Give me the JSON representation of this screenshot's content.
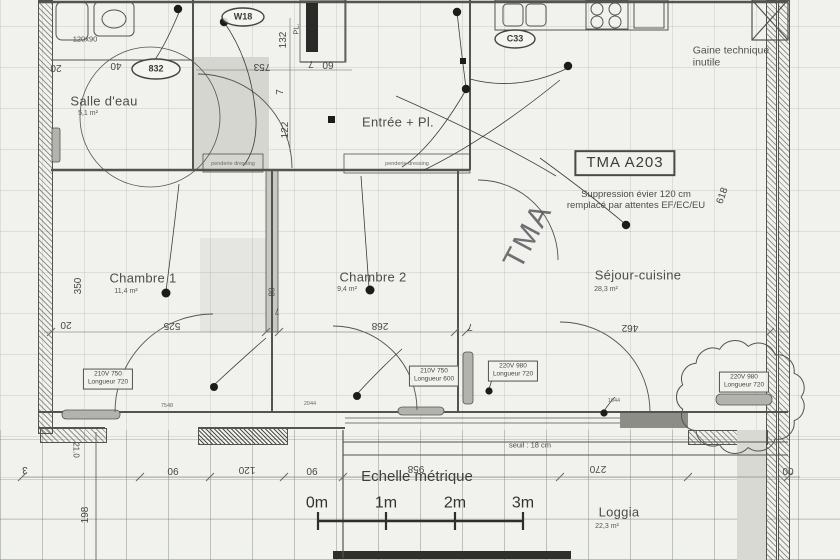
{
  "plan": {
    "unit_reference": "TMA A203",
    "rooms": [
      {
        "name": "Salle d'eau",
        "area": "5,1 m²"
      },
      {
        "name": "Entrée + Pl.",
        "area": ""
      },
      {
        "name": "Chambre 1",
        "area": "11,4 m²"
      },
      {
        "name": "Chambre 2",
        "area": "9,4 m²"
      },
      {
        "name": "Séjour-cuisine",
        "area": "28,3 m²"
      },
      {
        "name": "Loggia",
        "area": "22,3 m²"
      }
    ],
    "notes": [
      "Suppression évier 120 cm\nremplacé par attentes EF/EC/EU",
      "Gaine technique\ninutile",
      "seuil : 18 cm"
    ],
    "scale": {
      "title": "Echelle métrique",
      "ticks": [
        "0m",
        "1m",
        "2m",
        "3m"
      ]
    }
  },
  "labels": [
    {
      "id": "room-salle-deau",
      "text": "Salle d'eau",
      "x": 104,
      "y": 101,
      "cls": "room"
    },
    {
      "id": "area-salle-deau",
      "text": "5,1 m²",
      "x": 88,
      "y": 114,
      "cls": "area"
    },
    {
      "id": "room-entree",
      "text": "Entrée + Pl.",
      "x": 398,
      "y": 122,
      "cls": "room"
    },
    {
      "id": "room-chambre-1",
      "text": "Chambre 1",
      "x": 143,
      "y": 278,
      "cls": "room"
    },
    {
      "id": "area-chambre-1",
      "text": "11,4 m²",
      "x": 126,
      "y": 292,
      "cls": "area"
    },
    {
      "id": "room-chambre-2",
      "text": "Chambre 2",
      "x": 373,
      "y": 277,
      "cls": "room"
    },
    {
      "id": "area-chambre-2",
      "text": "9,4 m²",
      "x": 347,
      "y": 290,
      "cls": "area"
    },
    {
      "id": "room-sejour",
      "text": "Séjour-cuisine",
      "x": 638,
      "y": 275,
      "cls": "room"
    },
    {
      "id": "area-sejour",
      "text": "28,3 m²",
      "x": 606,
      "y": 290,
      "cls": "area"
    },
    {
      "id": "room-loggia",
      "text": "Loggia",
      "x": 619,
      "y": 512,
      "cls": "room"
    },
    {
      "id": "area-loggia",
      "text": "22,3 m²",
      "x": 607,
      "y": 527,
      "cls": "area"
    },
    {
      "id": "unit-ref",
      "text": "TMA A203",
      "x": 625,
      "y": 163,
      "cls": "refbox"
    },
    {
      "id": "note-suppression",
      "text": "Suppression évier 120 cm\nremplacé par attentes EF/EC/EU",
      "x": 636,
      "y": 200,
      "cls": "note"
    },
    {
      "id": "note-gaine",
      "text": "Gaine technique\ninutile",
      "x": 731,
      "y": 57,
      "cls": "note-left"
    },
    {
      "id": "watermark-tma",
      "text": "TMA",
      "x": 528,
      "y": 236,
      "rot": -62,
      "cls": "watermark"
    },
    {
      "id": "scale-title",
      "text": "Echelle métrique",
      "x": 417,
      "y": 477,
      "cls": "scale-title"
    },
    {
      "id": "scale-0m",
      "text": "0m",
      "x": 317,
      "y": 504,
      "cls": "scale-tick"
    },
    {
      "id": "scale-1m",
      "text": "1m",
      "x": 386,
      "y": 504,
      "cls": "scale-tick"
    },
    {
      "id": "scale-2m",
      "text": "2m",
      "x": 455,
      "y": 504,
      "cls": "scale-tick"
    },
    {
      "id": "scale-3m",
      "text": "3m",
      "x": 523,
      "y": 504,
      "cls": "scale-tick"
    },
    {
      "id": "dim-753",
      "text": "753",
      "x": 262,
      "y": 66,
      "rot": 180,
      "cls": "dim"
    },
    {
      "id": "dim-60",
      "text": "60",
      "x": 328,
      "y": 64,
      "rot": 180,
      "cls": "dim"
    },
    {
      "id": "dim-7-a",
      "text": "7",
      "x": 311,
      "y": 63,
      "rot": 180,
      "cls": "dim"
    },
    {
      "id": "dim-132",
      "text": "132",
      "x": 284,
      "y": 40,
      "rot": -90,
      "cls": "dim"
    },
    {
      "id": "dim-7-b",
      "text": "7",
      "x": 281,
      "y": 92,
      "rot": -90,
      "cls": "dim"
    },
    {
      "id": "dim-122",
      "text": "122",
      "x": 286,
      "y": 130,
      "rot": -90,
      "cls": "dim"
    },
    {
      "id": "dim-20-a",
      "text": "20",
      "x": 56,
      "y": 67,
      "rot": 180,
      "cls": "dim"
    },
    {
      "id": "dim-40",
      "text": "40",
      "x": 116,
      "y": 65,
      "rot": 180,
      "cls": "dim"
    },
    {
      "id": "dim-350",
      "text": "350",
      "x": 79,
      "y": 286,
      "rot": -90,
      "cls": "dim"
    },
    {
      "id": "dim-20-b",
      "text": "20",
      "x": 66,
      "y": 324,
      "rot": 180,
      "cls": "dim"
    },
    {
      "id": "dim-525",
      "text": "525",
      "x": 172,
      "y": 325,
      "rot": 180,
      "cls": "dim"
    },
    {
      "id": "dim-80",
      "text": "80",
      "x": 272,
      "y": 292,
      "rot": -90,
      "cls": "dim-sm"
    },
    {
      "id": "dim-7-c",
      "text": "7",
      "x": 277,
      "y": 311,
      "rot": 180,
      "cls": "dim-sm"
    },
    {
      "id": "dim-268",
      "text": "268",
      "x": 380,
      "y": 325,
      "rot": 180,
      "cls": "dim"
    },
    {
      "id": "dim-7-d",
      "text": "7",
      "x": 470,
      "y": 326,
      "rot": 180,
      "cls": "dim"
    },
    {
      "id": "dim-462",
      "text": "462",
      "x": 630,
      "y": 327,
      "rot": 180,
      "cls": "dim"
    },
    {
      "id": "dim-618",
      "text": "618",
      "x": 723,
      "y": 196,
      "rot": -70,
      "cls": "dim"
    },
    {
      "id": "dim-90-a",
      "text": "90",
      "x": 173,
      "y": 470,
      "rot": 180,
      "cls": "dim"
    },
    {
      "id": "dim-120",
      "text": "120",
      "x": 247,
      "y": 469,
      "rot": 180,
      "cls": "dim"
    },
    {
      "id": "dim-90-b",
      "text": "90",
      "x": 312,
      "y": 470,
      "rot": 180,
      "cls": "dim"
    },
    {
      "id": "dim-958",
      "text": "958",
      "x": 416,
      "y": 468,
      "rot": 180,
      "cls": "dim"
    },
    {
      "id": "dim-270",
      "text": "270",
      "x": 598,
      "y": 468,
      "rot": 180,
      "cls": "dim"
    },
    {
      "id": "dim-00",
      "text": "00",
      "x": 788,
      "y": 470,
      "rot": 180,
      "cls": "dim"
    },
    {
      "id": "dim-3",
      "text": "3",
      "x": 25,
      "y": 469,
      "rot": 180,
      "cls": "dim"
    },
    {
      "id": "dim-21-0",
      "text": "21.0",
      "x": 76,
      "y": 450,
      "rot": 90,
      "cls": "dim-sm"
    },
    {
      "id": "dim-198",
      "text": "198",
      "x": 86,
      "y": 515,
      "rot": -90,
      "cls": "dim"
    },
    {
      "id": "note-seuil",
      "text": "seuil : 18 cm",
      "x": 530,
      "y": 446,
      "cls": "tiny"
    },
    {
      "id": "tag-832",
      "text": "832",
      "x": 156,
      "y": 69,
      "cls": "oval-text"
    },
    {
      "id": "tag-w18",
      "text": "W18",
      "x": 243,
      "y": 17,
      "cls": "oval-text"
    },
    {
      "id": "tag-c33",
      "text": "C33",
      "x": 515,
      "y": 39,
      "cls": "oval-text"
    },
    {
      "id": "dim-120x90",
      "text": "120x90",
      "x": 85,
      "y": 40,
      "cls": "tiny"
    },
    {
      "id": "dim-pl",
      "text": "PL.",
      "x": 297,
      "y": 29,
      "rot": -90,
      "cls": "tiny"
    },
    {
      "id": "spec-chambre1",
      "text": "210V 750\nLongueur 720",
      "x": 108,
      "y": 379,
      "cls": "specbox"
    },
    {
      "id": "spec-chambre2",
      "text": "210V 750\nLongueur 600",
      "x": 434,
      "y": 376,
      "cls": "specbox"
    },
    {
      "id": "spec-sejour",
      "text": "220V 980\nLongueur 720",
      "x": 513,
      "y": 371,
      "cls": "specbox"
    },
    {
      "id": "spec-cloud",
      "text": "220V 980\nLongueur 720",
      "x": 744,
      "y": 382,
      "cls": "specbox"
    },
    {
      "id": "closet-label-1",
      "text": "penderie dressing",
      "x": 233,
      "y": 164,
      "cls": "micro"
    },
    {
      "id": "closet-label-2",
      "text": "penderie dressing",
      "x": 407,
      "y": 164,
      "cls": "micro"
    },
    {
      "id": "code-1",
      "text": "7548",
      "x": 167,
      "y": 406,
      "cls": "micro"
    },
    {
      "id": "code-2",
      "text": "2044",
      "x": 310,
      "y": 404,
      "cls": "micro"
    },
    {
      "id": "code-3",
      "text": "1044",
      "x": 614,
      "y": 401,
      "cls": "micro"
    }
  ]
}
